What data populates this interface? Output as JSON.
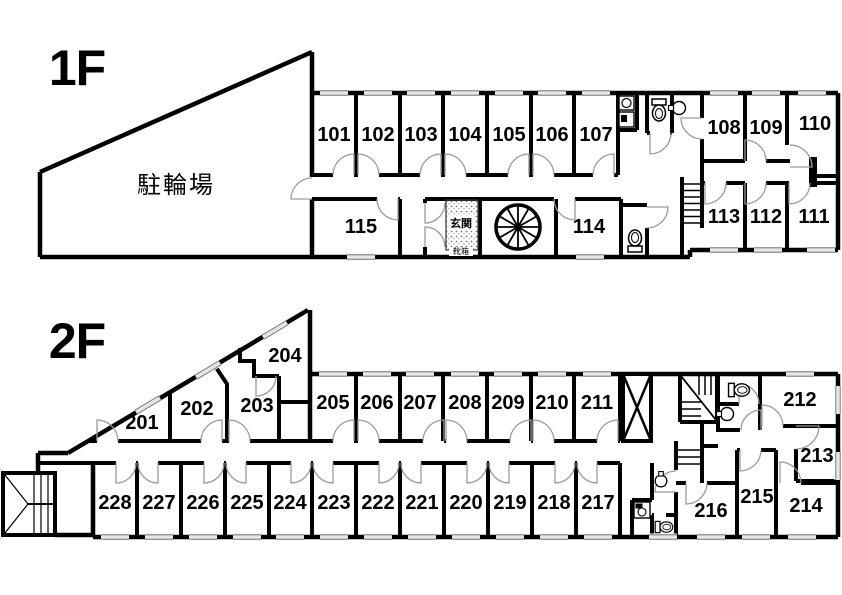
{
  "plan": {
    "type": "apartment-floor-plan",
    "colors": {
      "wall": "#000000",
      "door_arc": "#9a9a9a",
      "background": "#ffffff"
    },
    "floor1": {
      "label": "1F",
      "bike_parking_label": "駐輪場",
      "entrance_label": "玄関",
      "shoe_box_label": "靴箱",
      "rooms": {
        "r101": "101",
        "r102": "102",
        "r103": "103",
        "r104": "104",
        "r105": "105",
        "r106": "106",
        "r107": "107",
        "r108": "108",
        "r109": "109",
        "r110": "110",
        "r111": "111",
        "r112": "112",
        "r113": "113",
        "r114": "114",
        "r115": "115"
      }
    },
    "floor2": {
      "label": "2F",
      "rooms": {
        "r201": "201",
        "r202": "202",
        "r203": "203",
        "r204": "204",
        "r205": "205",
        "r206": "206",
        "r207": "207",
        "r208": "208",
        "r209": "209",
        "r210": "210",
        "r211": "211",
        "r212": "212",
        "r213": "213",
        "r214": "214",
        "r215": "215",
        "r216": "216",
        "r217": "217",
        "r218": "218",
        "r219": "219",
        "r220": "220",
        "r221": "221",
        "r222": "222",
        "r223": "223",
        "r224": "224",
        "r225": "225",
        "r226": "226",
        "r227": "227",
        "r228": "228"
      }
    }
  }
}
